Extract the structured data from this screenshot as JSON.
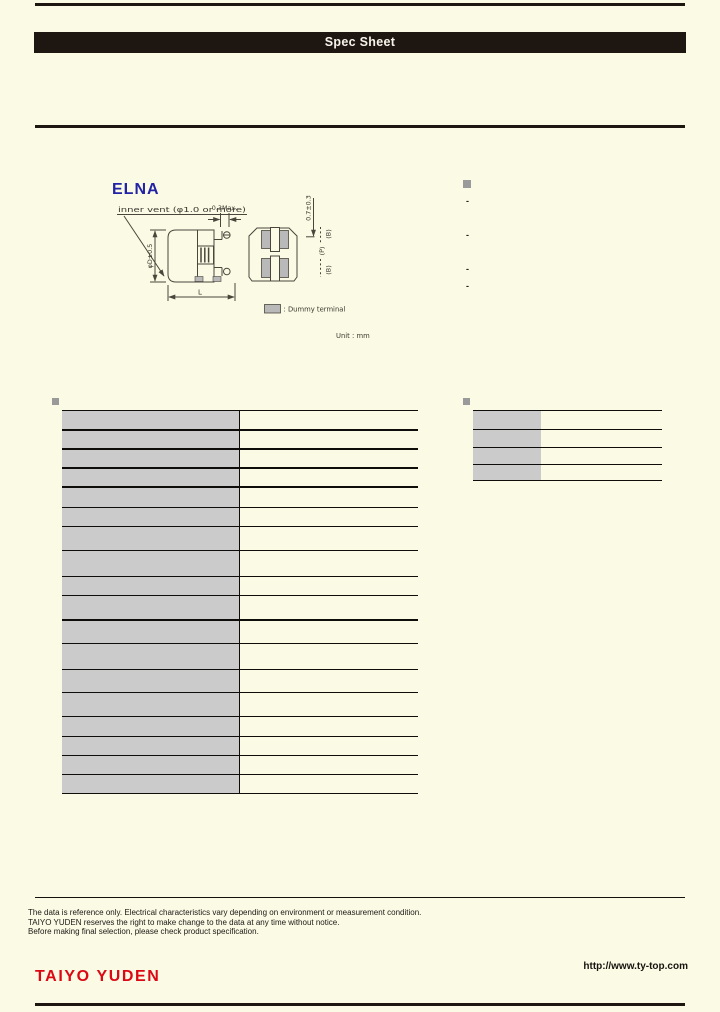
{
  "header": {
    "title_bar": "Spec Sheet"
  },
  "brand": {
    "elna_logo": "ELNA"
  },
  "drawing": {
    "inner_vent_label": "inner vent (φ1.0 or more)",
    "top_gap_dim": "0.3Max.",
    "diameter_dim": "φD±0.5",
    "length_dim": "L",
    "height_dim": "0.7±0.3",
    "dim_b_top": "(B)",
    "dim_p": "(P)",
    "dim_b_bottom": "(B)",
    "legend_dummy_terminal": ": Dummy terminal",
    "unit_note": "Unit : mm"
  },
  "features": {
    "items": [
      "-",
      "-",
      "-",
      "-"
    ]
  },
  "footer": {
    "disclaimer_lines": [
      "The data is reference only. Electrical characteristics vary depending on environment or measurement condition.",
      "TAIYO YUDEN reserves the right to make change to the data at any time without notice.",
      "Before making final selection, please check product specification."
    ],
    "website_url": "http://www.ty-top.com",
    "taiyo_yuden_logo": "TAIYO YUDEN"
  },
  "colors": {
    "background": "#FAFAE5",
    "bar_black": "#1E1610",
    "cell_gray": "#CBCBCB",
    "elna_blue": "#2323A5",
    "taiyo_red": "#DC0814"
  }
}
